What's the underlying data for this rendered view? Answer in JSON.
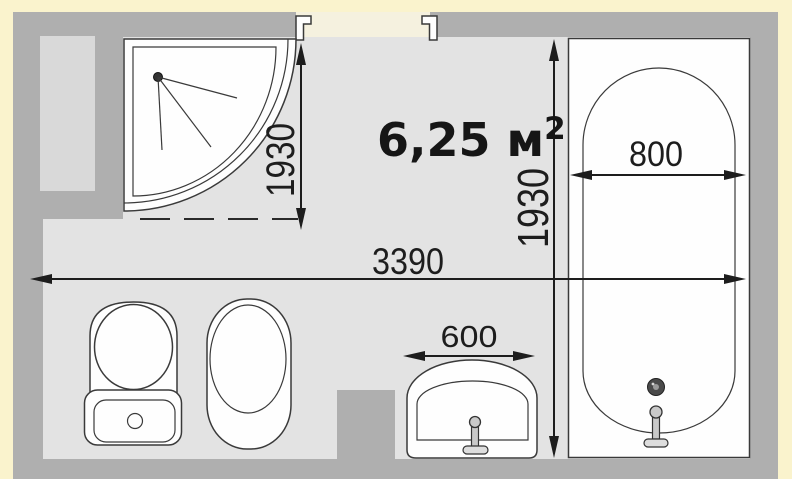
{
  "plan": {
    "kind": "bathroom-floor-plan",
    "area_label": {
      "value": "6,25 м",
      "superscript": "2"
    },
    "dimensions": {
      "room_width_mm": "3390",
      "room_depth_mm": "1930",
      "shower_depth_mm": "1930",
      "bathtub_width_mm": "800",
      "sink_width_mm": "600"
    },
    "fixtures": [
      "corner-shower",
      "bathtub",
      "washbasin",
      "toilet",
      "bidet"
    ],
    "colors": {
      "background": "#FAF3CD",
      "wall": "#AFAFAF",
      "floor": "#E3E3E3",
      "wall_niche": "#D9D9D9",
      "doorway_opening": "#F5F1DF",
      "fixture_fill": "#FEFEFE",
      "line": "#1D1D1D"
    }
  }
}
